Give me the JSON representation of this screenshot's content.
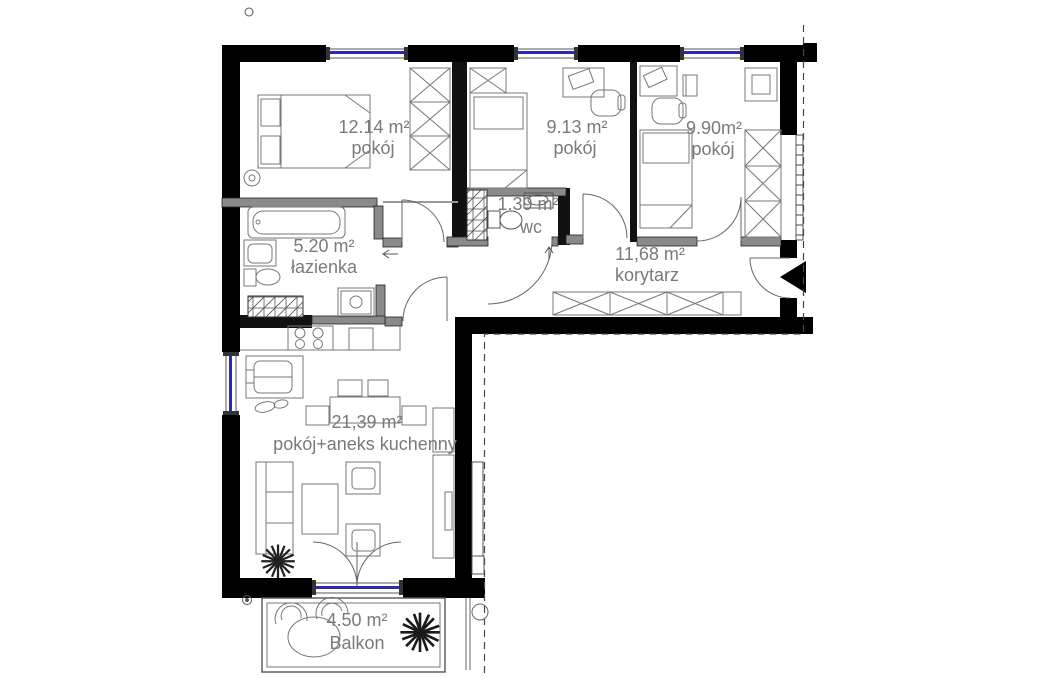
{
  "plan_title": "apartment-floor-plan",
  "rooms": {
    "room1": {
      "area": "12.14 m²",
      "name": "pokój"
    },
    "room2": {
      "area": "9.13 m²",
      "name": "pokój"
    },
    "room3": {
      "area": "9.90m²",
      "name": "pokój"
    },
    "wc": {
      "area": "1.39 m²",
      "name": "wc"
    },
    "bathroom": {
      "area": "5.20 m²",
      "name": "łazienka"
    },
    "corridor": {
      "area": "11,68 m²",
      "name": "korytarz"
    },
    "living": {
      "area": "21,39 m²",
      "name": "pokój+aneks kuchenny"
    },
    "balcony": {
      "area": "4.50 m²",
      "name": "Balkon"
    }
  },
  "colors": {
    "wall": "#000000",
    "partition": "#8a8a8a",
    "window_glass": "#2a2ab5",
    "label_text": "#7a7a7a",
    "dashed_boundary": "#444444",
    "furniture_line": "#777777"
  }
}
